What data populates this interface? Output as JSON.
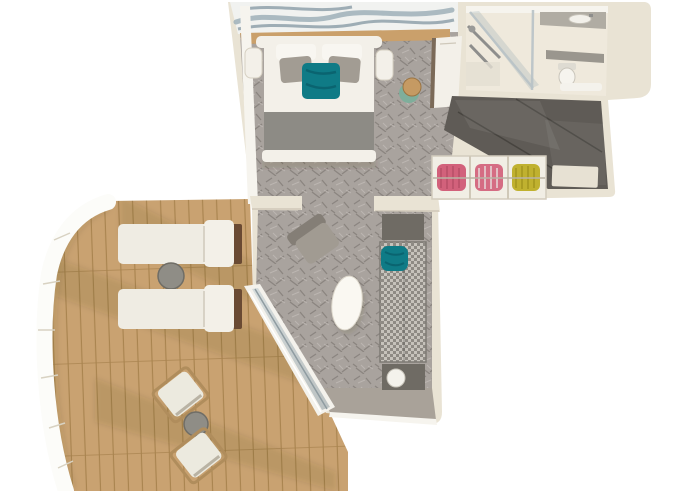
{
  "meta": {
    "title": "cruise-suite-3d-floor-plan",
    "view": "top-down axonometric render",
    "visible_text": "none"
  },
  "palette": {
    "background": "#ffffff",
    "wall": "#e9e3d4",
    "wall_top": "#f6f4ee",
    "carpet": "#a9a39e",
    "carpet_motif": "#8b8580",
    "carpet_light": "#bcb6b1",
    "deck": "#c9a271",
    "deck_line": "#a8834e",
    "railing": "#fcfcf9",
    "railing_edge": "#c9bd90",
    "dark_floor": "#5f5b56",
    "dark_floor_line": "#47443f",
    "bath_floor": "#efe9dc",
    "counter": "#b0aca3",
    "glass": "#b9c3c7",
    "bed_white": "#f3f0e9",
    "blanket": "#8d8b85",
    "pillow_gray": "#a29c93",
    "teal": "#0f7b86",
    "sofa_check_a": "#c6c2bb",
    "sofa_check_b": "#8e8a84",
    "table_dark": "#6f6b64",
    "lamp_white": "#f4f2ec",
    "clothes_pink": "#d2617b",
    "clothes_yellow": "#c0b12f",
    "stool_tan": "#c59a63",
    "stool_green": "#7fae9b",
    "art_wave": "#9fb0b8",
    "taupe": "#a9a299",
    "lounger_frame": "#6a4a33",
    "chair_frame": "#b08d5c"
  },
  "rooms": [
    {
      "id": "bedroom",
      "name": "Bedroom",
      "furniture": [
        "double-bed",
        "headboard",
        "nightstand-left",
        "nightstand-right",
        "teal-accent-pillow",
        "gray-pillows",
        "foot-blanket",
        "vanity-desk",
        "stool",
        "wave-artwork-wall",
        "patterned-carpet"
      ]
    },
    {
      "id": "bathroom",
      "name": "Bathroom",
      "furniture": [
        "glass-shower",
        "shower-fixture",
        "vanity-counter-with-sink",
        "shelf-counter",
        "toilet",
        "bath-mat"
      ]
    },
    {
      "id": "entry",
      "name": "Entry Hall",
      "furniture": [
        "dark-tile-floor",
        "floor-mat"
      ]
    },
    {
      "id": "closet",
      "name": "Wardrobe Closet",
      "furniture": [
        "hanging-clothes-pink",
        "hanging-clothes-pink-2",
        "hanging-clothes-yellow"
      ]
    },
    {
      "id": "living-room",
      "name": "Living Room",
      "furniture": [
        "checkered-sofa",
        "teal-throw",
        "side-table-top",
        "side-table-bottom",
        "table-lamp",
        "armchair",
        "oval-coffee-table",
        "sliding-glass-door",
        "patterned-carpet"
      ]
    },
    {
      "id": "balcony",
      "name": "Balcony Deck",
      "furniture": [
        "wood-plank-deck",
        "curved-white-railing",
        "sun-lounger-1",
        "sun-lounger-2",
        "round-side-table-loungers",
        "deck-chair-1",
        "deck-chair-2",
        "round-side-table-chairs"
      ]
    }
  ]
}
